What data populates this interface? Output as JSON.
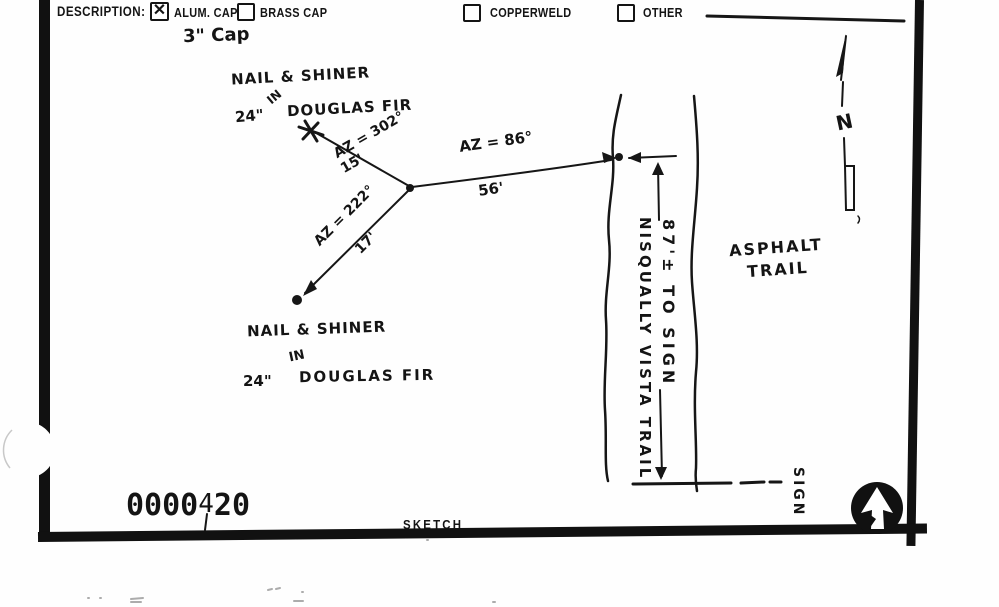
{
  "form": {
    "description_label": "DESCRIPTION:",
    "options": [
      {
        "label": "ALUM. CAP",
        "mark": "✕",
        "checked": true
      },
      {
        "label": "BRASS CAP",
        "mark": "",
        "checked": false
      },
      {
        "label": "COPPERWELD",
        "mark": "",
        "checked": false
      },
      {
        "label": "OTHER",
        "mark": "",
        "checked": false
      }
    ],
    "cap_note": "3\" Cap"
  },
  "sketch": {
    "north_label": "N",
    "tree_north": {
      "line1": "NAIL & SHINER",
      "line2": "IN",
      "size": "24\"",
      "species": "DOUGLAS FIR"
    },
    "tree_south": {
      "line1": "NAIL & SHINER",
      "line2": "IN",
      "size": "24\"",
      "species": "DOUGLAS FIR"
    },
    "tie_nw": {
      "azimuth": "AZ = 302°",
      "distance": "15'"
    },
    "tie_sw": {
      "azimuth": "AZ = 222°",
      "distance": "17'"
    },
    "tie_e": {
      "azimuth": "AZ = 86°",
      "distance": "56'"
    },
    "dimension_to_sign": "87'± TO SIGN",
    "trail_name": "NISQUALLY VISTA TRAIL",
    "surface_line1": "ASPHALT",
    "surface_line2": "TRAIL",
    "sign_label": "SIGN"
  },
  "footer": {
    "stamp_prefix": "0000",
    "stamp_mid": "4",
    "stamp_suffix": "20",
    "section_label": "SKETCH"
  }
}
